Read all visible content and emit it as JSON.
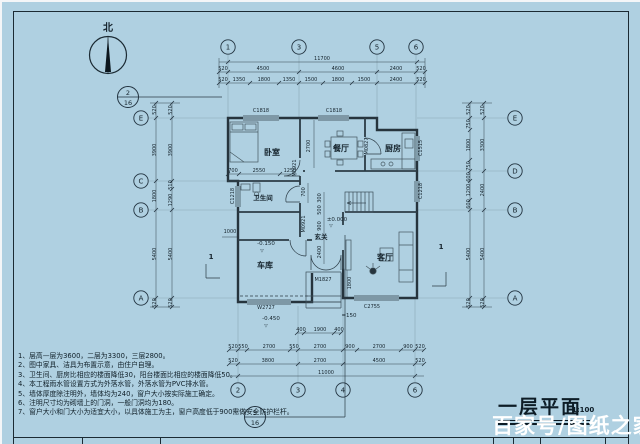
{
  "title": {
    "text": "一层平面",
    "scale": "1:100"
  },
  "watermark": "百家号/图纸之家",
  "north_label": "北",
  "notes": [
    "1、层高—层为3600，二层为3300，三层2800。",
    "2、图中家具、洁具为布置示意，由住户自理。",
    "3、卫生间、厨房比相应的楼面降低30，阳台楼面比相应的楼面降低50。",
    "4、本工程雨水管设置方式为外落水管，外落水管为PVC排水管。",
    "5、墙体厚度除注明外，墙体均为240，窗户大小按实际施工确定。",
    "6、注明尺寸均为砌墙上的门洞，一般门洞均为180。",
    "7、窗户大小和门大小为适宜大小，以具体施工为主，窗户高度低于900需做安全防护栏杆。"
  ],
  "plan": {
    "grid_bubbles": [
      {
        "t": "1",
        "x": 228,
        "y": 47
      },
      {
        "t": "3",
        "x": 299,
        "y": 47
      },
      {
        "t": "5",
        "x": 377,
        "y": 47
      },
      {
        "t": "6",
        "x": 416,
        "y": 47
      },
      {
        "t": "2",
        "x": 238,
        "y": 390
      },
      {
        "t": "3",
        "x": 298,
        "y": 390
      },
      {
        "t": "4",
        "x": 343,
        "y": 390
      },
      {
        "t": "6",
        "x": 415,
        "y": 390
      },
      {
        "t": "E",
        "x": 141,
        "y": 118
      },
      {
        "t": "C",
        "x": 141,
        "y": 181
      },
      {
        "t": "B",
        "x": 141,
        "y": 210
      },
      {
        "t": "A",
        "x": 141,
        "y": 298
      },
      {
        "t": "E",
        "x": 515,
        "y": 118
      },
      {
        "t": "D",
        "x": 515,
        "y": 171
      },
      {
        "t": "B",
        "x": 515,
        "y": 210
      },
      {
        "t": "A",
        "x": 515,
        "y": 298
      }
    ],
    "detail_markers": [
      {
        "num": "2",
        "den": "16",
        "x": 128,
        "y": 97
      },
      {
        "num": "5",
        "den": "16",
        "x": 255,
        "y": 417
      }
    ],
    "labels": [
      {
        "t": "北",
        "x": 108,
        "y": 31,
        "s": 10,
        "c": "room",
        "n": "north-label"
      },
      {
        "t": "11700",
        "x": 322,
        "y": 60
      },
      {
        "t": "520",
        "x": 223,
        "y": 70
      },
      {
        "t": "4500",
        "x": 263,
        "y": 70
      },
      {
        "t": "4600",
        "x": 338,
        "y": 70
      },
      {
        "t": "2400",
        "x": 396,
        "y": 70
      },
      {
        "t": "520",
        "x": 421,
        "y": 70
      },
      {
        "t": "520",
        "x": 223,
        "y": 81
      },
      {
        "t": "1350",
        "x": 239,
        "y": 81
      },
      {
        "t": "1800",
        "x": 264,
        "y": 81
      },
      {
        "t": "1350",
        "x": 289,
        "y": 81
      },
      {
        "t": "1500",
        "x": 311,
        "y": 81
      },
      {
        "t": "1800",
        "x": 338,
        "y": 81
      },
      {
        "t": "1500",
        "x": 364,
        "y": 81
      },
      {
        "t": "2400",
        "x": 396,
        "y": 81
      },
      {
        "t": "520",
        "x": 421,
        "y": 81
      },
      {
        "t": "520",
        "x": 156,
        "y": 110,
        "r": -90
      },
      {
        "t": "3900",
        "x": 156,
        "y": 150,
        "r": -90
      },
      {
        "t": "1800",
        "x": 156,
        "y": 196,
        "r": -90
      },
      {
        "t": "5400",
        "x": 156,
        "y": 254,
        "r": -90
      },
      {
        "t": "520",
        "x": 156,
        "y": 303,
        "r": -90
      },
      {
        "t": "520",
        "x": 172,
        "y": 110,
        "r": -90
      },
      {
        "t": "3900",
        "x": 172,
        "y": 150,
        "r": -90
      },
      {
        "t": "510",
        "x": 172,
        "y": 185,
        "r": -90
      },
      {
        "t": "1290",
        "x": 172,
        "y": 200,
        "r": -90
      },
      {
        "t": "5400",
        "x": 172,
        "y": 254,
        "r": -90
      },
      {
        "t": "520",
        "x": 172,
        "y": 303,
        "r": -90
      },
      {
        "t": "520",
        "x": 470,
        "y": 110,
        "r": -90
      },
      {
        "t": "750",
        "x": 470,
        "y": 124,
        "r": -90
      },
      {
        "t": "1800",
        "x": 470,
        "y": 145,
        "r": -90
      },
      {
        "t": "750",
        "x": 470,
        "y": 166,
        "r": -90
      },
      {
        "t": "600",
        "x": 470,
        "y": 177,
        "r": -90
      },
      {
        "t": "1200",
        "x": 470,
        "y": 190,
        "r": -90
      },
      {
        "t": "600",
        "x": 470,
        "y": 204,
        "r": -90
      },
      {
        "t": "5400",
        "x": 470,
        "y": 254,
        "r": -90
      },
      {
        "t": "520",
        "x": 470,
        "y": 303,
        "r": -90
      },
      {
        "t": "520",
        "x": 484,
        "y": 110,
        "r": -90
      },
      {
        "t": "3300",
        "x": 484,
        "y": 145,
        "r": -90
      },
      {
        "t": "2400",
        "x": 484,
        "y": 190,
        "r": -90
      },
      {
        "t": "5400",
        "x": 484,
        "y": 254,
        "r": -90
      },
      {
        "t": "520",
        "x": 484,
        "y": 303,
        "r": -90
      },
      {
        "t": "400",
        "x": 301,
        "y": 331
      },
      {
        "t": "1900",
        "x": 320,
        "y": 331
      },
      {
        "t": "400",
        "x": 339,
        "y": 331
      },
      {
        "t": "520",
        "x": 233,
        "y": 348
      },
      {
        "t": "550",
        "x": 243,
        "y": 348
      },
      {
        "t": "2700",
        "x": 269,
        "y": 348
      },
      {
        "t": "550",
        "x": 294,
        "y": 348
      },
      {
        "t": "2700",
        "x": 320,
        "y": 348
      },
      {
        "t": "900",
        "x": 350,
        "y": 348
      },
      {
        "t": "2700",
        "x": 379,
        "y": 348
      },
      {
        "t": "900",
        "x": 408,
        "y": 348
      },
      {
        "t": "520",
        "x": 420,
        "y": 348
      },
      {
        "t": "520",
        "x": 233,
        "y": 362
      },
      {
        "t": "3800",
        "x": 268,
        "y": 362
      },
      {
        "t": "2700",
        "x": 320,
        "y": 362
      },
      {
        "t": "4500",
        "x": 379,
        "y": 362
      },
      {
        "t": "520",
        "x": 420,
        "y": 362
      },
      {
        "t": "11000",
        "x": 326,
        "y": 374
      },
      {
        "t": "700",
        "x": 233,
        "y": 172
      },
      {
        "t": "2550",
        "x": 259,
        "y": 172
      },
      {
        "t": "1250",
        "x": 290,
        "y": 172
      },
      {
        "t": "2700",
        "x": 310,
        "y": 146,
        "r": -90
      },
      {
        "t": "300",
        "x": 321,
        "y": 198,
        "r": -90
      },
      {
        "t": "500",
        "x": 321,
        "y": 210,
        "r": -90
      },
      {
        "t": "900",
        "x": 321,
        "y": 226,
        "r": -90
      },
      {
        "t": "2400",
        "x": 321,
        "y": 252,
        "r": -90
      },
      {
        "t": "700",
        "x": 305,
        "y": 192,
        "r": -90
      },
      {
        "t": "1800",
        "x": 351,
        "y": 283,
        "r": -90
      },
      {
        "t": "1000",
        "x": 230,
        "y": 233
      },
      {
        "t": "C1818",
        "x": 261,
        "y": 112,
        "c": "tag",
        "n": "window-c1818-bedroom"
      },
      {
        "t": "C1818",
        "x": 334,
        "y": 112,
        "c": "tag",
        "n": "window-c1818-dining"
      },
      {
        "t": "C1515",
        "x": 422,
        "y": 148,
        "r": -90,
        "c": "tag",
        "n": "window-c1515-kitchen"
      },
      {
        "t": "C1218",
        "x": 422,
        "y": 191,
        "r": -90,
        "c": "tag",
        "n": "window-c1218-east"
      },
      {
        "t": "C1218",
        "x": 234,
        "y": 196,
        "r": -90,
        "c": "tag",
        "n": "window-c1218-bath"
      },
      {
        "t": "C2755",
        "x": 372,
        "y": 308,
        "c": "tag",
        "n": "window-c2755-living"
      },
      {
        "t": "W2727",
        "x": 266,
        "y": 309,
        "c": "tag",
        "n": "window-w2727-garage"
      },
      {
        "t": "M1827",
        "x": 323,
        "y": 281,
        "c": "tag",
        "n": "door-m1827-entry"
      },
      {
        "t": "M0921",
        "x": 296,
        "y": 168,
        "r": -90,
        "c": "tag",
        "n": "door-m0921-bedroom"
      },
      {
        "t": "M0921",
        "x": 305,
        "y": 224,
        "r": -90,
        "c": "tag",
        "n": "door-m0921-bath"
      },
      {
        "t": "M0827",
        "x": 368,
        "y": 146,
        "r": -90,
        "c": "tag",
        "n": "door-m0827-kitchen"
      },
      {
        "t": "卧室",
        "x": 272,
        "y": 155,
        "c": "room",
        "n": "room-bedroom"
      },
      {
        "t": "餐厅",
        "x": 341,
        "y": 151,
        "c": "room",
        "n": "room-dining"
      },
      {
        "t": "厨房",
        "x": 393,
        "y": 151,
        "c": "room",
        "n": "room-kitchen"
      },
      {
        "t": "卫生间",
        "x": 263,
        "y": 200,
        "s": 6.5,
        "c": "room",
        "n": "room-bathroom"
      },
      {
        "t": "玄关",
        "x": 321,
        "y": 239,
        "s": 6.5,
        "c": "room",
        "n": "room-foyer"
      },
      {
        "t": "车库",
        "x": 265,
        "y": 268,
        "c": "room",
        "n": "room-garage"
      },
      {
        "t": "客厅",
        "x": 385,
        "y": 260,
        "c": "room",
        "n": "room-living"
      },
      {
        "t": "±0.000",
        "x": 337,
        "y": 221,
        "c": "lvl",
        "n": "level-zero"
      },
      {
        "t": "▽",
        "x": 331,
        "y": 227,
        "s": 4.5,
        "c": "lvl"
      },
      {
        "t": "-0.150",
        "x": 266,
        "y": 245,
        "c": "lvl",
        "n": "level-minus150"
      },
      {
        "t": "▽",
        "x": 262,
        "y": 252,
        "s": 4.5,
        "c": "lvl"
      },
      {
        "t": "-0.450",
        "x": 271,
        "y": 320,
        "c": "lvl",
        "n": "level-minus450"
      },
      {
        "t": "▽",
        "x": 266,
        "y": 327,
        "s": 4.5,
        "c": "lvl"
      },
      {
        "t": "=150",
        "x": 349,
        "y": 317,
        "c": "lvl",
        "n": "step-note"
      },
      {
        "t": "1",
        "x": 211,
        "y": 259,
        "c": "sec",
        "n": "section-mark-1-left"
      },
      {
        "t": "1",
        "x": 441,
        "y": 249,
        "c": "sec",
        "n": "section-mark-1-right"
      }
    ]
  }
}
